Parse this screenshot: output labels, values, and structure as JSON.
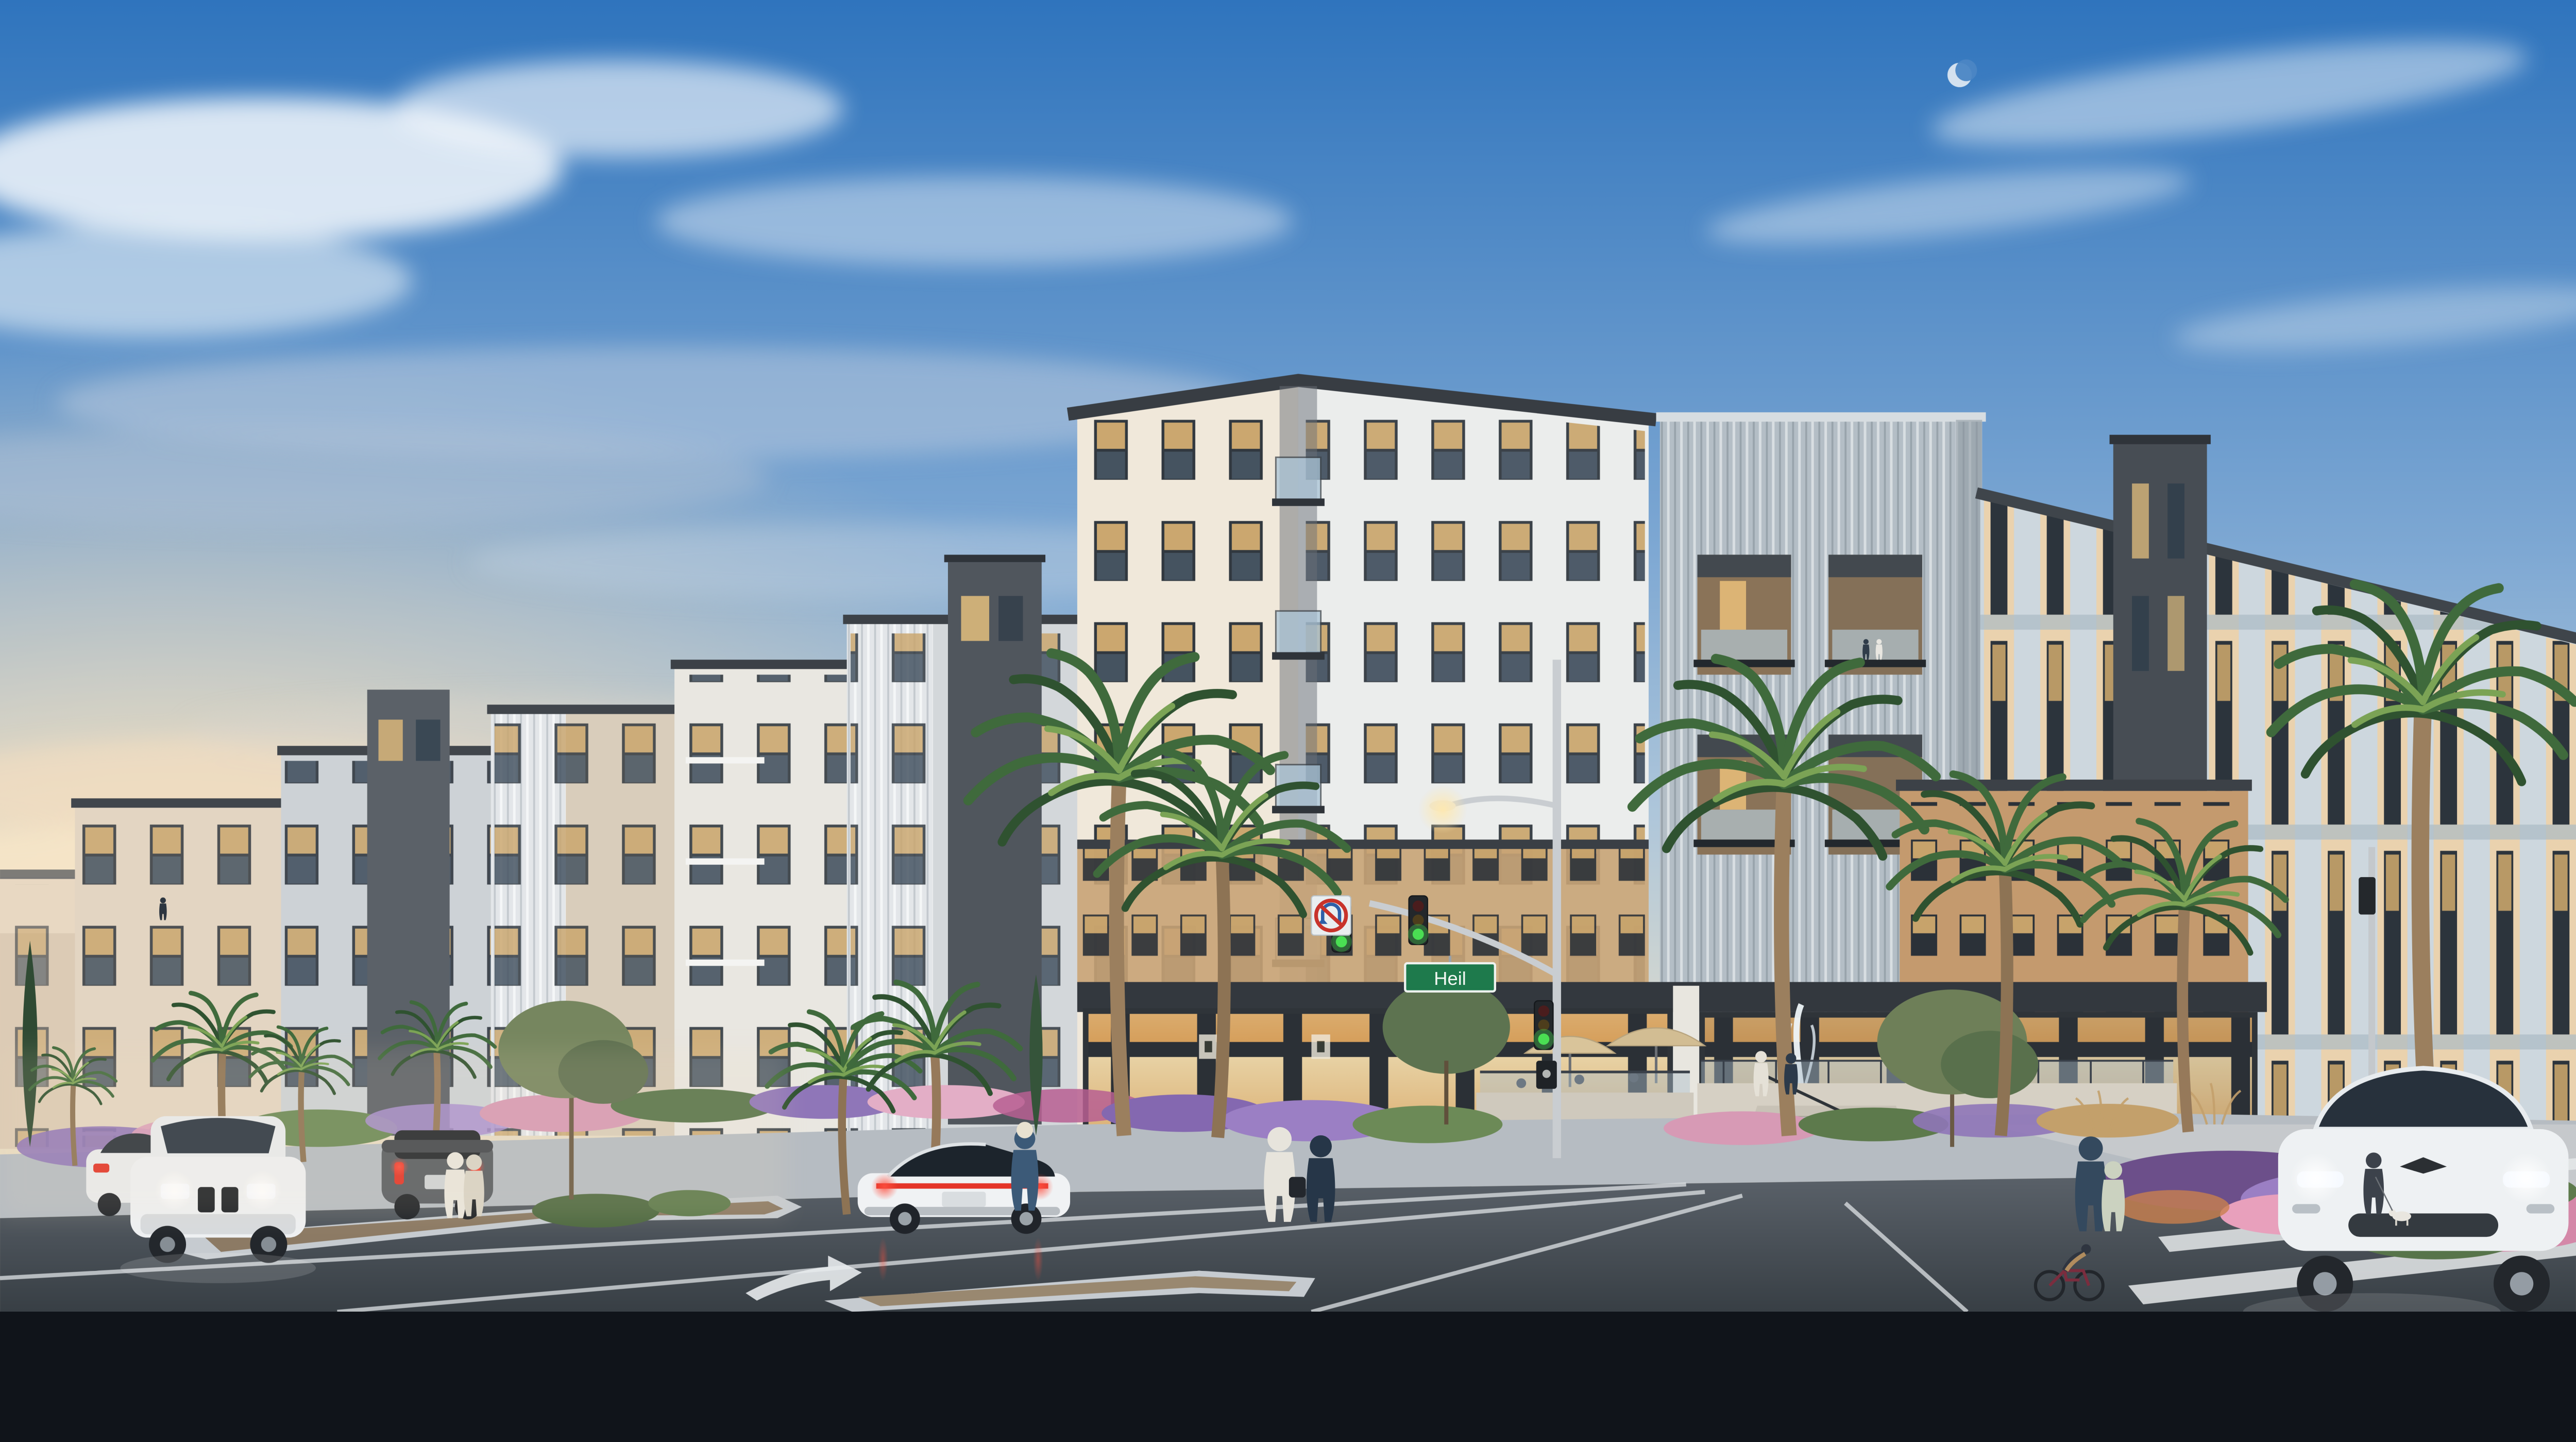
{
  "title": "Dusk architectural rendering of a modern mixed-use apartment community at a street corner",
  "street_sign": {
    "label": "Heil"
  },
  "signage": {
    "no_u_turn": "No U-turn regulatory sign mounted by the signal mast arm",
    "pedestrian_signal": "pedestrian signal box on the corner pole"
  },
  "traffic_signals": {
    "visible_heads": 3,
    "state": "green",
    "street_light": "lit cobra-head street lamp above the mast arm"
  },
  "sky": {
    "condition": "clear blue evening sky with soft clouds",
    "sunset": "warm golden glow low on the left horizon",
    "moon": "faint crescent moon in the upper right"
  },
  "buildings": {
    "stories": "4-5 story stepped volumes",
    "corner_building": "white stucco corner volume with dark parapet cap, recessed corner balconies with glass railings, wood-look band above the storefront",
    "metal_tower": "silver corrugated-metal tower with recessed wood-lined balconies and glass rails",
    "right_wing": "light blue-gray facade with vertical pilaster window bays and a dark charcoal accent tower",
    "left_wing": "receding row of white, tan, gray and white-corrugated volumes with glass balconies",
    "ground_floor": "full-height glass storefronts glowing with warm light; lobby with framed artwork and lounge seating visible inside"
  },
  "amenities": {
    "fountain": "plaza fountain jet on a raised terrace",
    "terrace": "raised terrace with glass guardrail, entry stair and metal handrail",
    "patio": "sidewalk cafe patio with tan market umbrellas and diners"
  },
  "street": {
    "surface": "asphalt with white lane lines",
    "markings": [
      "curved turn-lane arrow",
      "crosswalk stripes at the right corner"
    ],
    "median": "landscaped medians with concrete curbs, gravel and shrubs",
    "sidewalk": "wide concrete sidewalks with planting beds"
  },
  "vehicles": [
    {
      "name": "white-suv",
      "description": "white SUV approaching with headlights on, left lane"
    },
    {
      "name": "gray-hatchback",
      "description": "dark gray electric hatchback driving away, taillights lit"
    },
    {
      "name": "white-sedan-far-left",
      "description": "white sedan driving away at far left, taillights lit"
    },
    {
      "name": "white-electric-sedan",
      "description": "white electric sedan driving away in center, full-width taillight bar lit"
    },
    {
      "name": "white-electric-suv",
      "description": "white electric SUV stopped at the right crosswalk, headlights on"
    }
  ],
  "people": [
    "two women walking on the left sidewalk",
    "woman in a sun hat walking mid-block",
    "man in a white shirt on the phone carrying a bag",
    "woman in dark romper checking her phone",
    "mother and child holding hands on the right walkway",
    "man walking a small white dog at the right corner",
    "cyclist riding along the right curb",
    "residents standing on balconies",
    "visitors by the fountain terrace",
    "diners under the patio umbrellas"
  ],
  "landscaping": [
    "tall fan palms along both streets",
    "king palms at the corner",
    "slender cypress trees",
    "olive trees on the median",
    "purple lavender drifts",
    "pink muhly grass",
    "magenta flowering shrubs",
    "tan ornamental grasses"
  ],
  "palette": {
    "sky_top": "#2f74bd",
    "sky_mid": "#8fb3d8",
    "horizon_warm": "#f6dfbb",
    "building_white": "#efede6",
    "building_tan": "#c49a6e",
    "metal_silver": "#b4bec6",
    "accent_charcoal": "#474d54",
    "wood_balcony": "#8a7358",
    "storefront_glow": "#f3cd8c",
    "parapet_dark": "#383d43",
    "road_asphalt": "#474e55",
    "sidewalk": "#b6bcc2",
    "median_gravel": "#8c7a64",
    "sign_green": "#1e7a4c",
    "signal_green": "#4ade53",
    "taillight_red": "#e43428",
    "headlight_white": "#f3f8ff",
    "palm_green": "#3f6a3c",
    "lavender": "#8f76b8",
    "pink_grass": "#dc9fba",
    "shrub_green": "#5d7a4c"
  }
}
